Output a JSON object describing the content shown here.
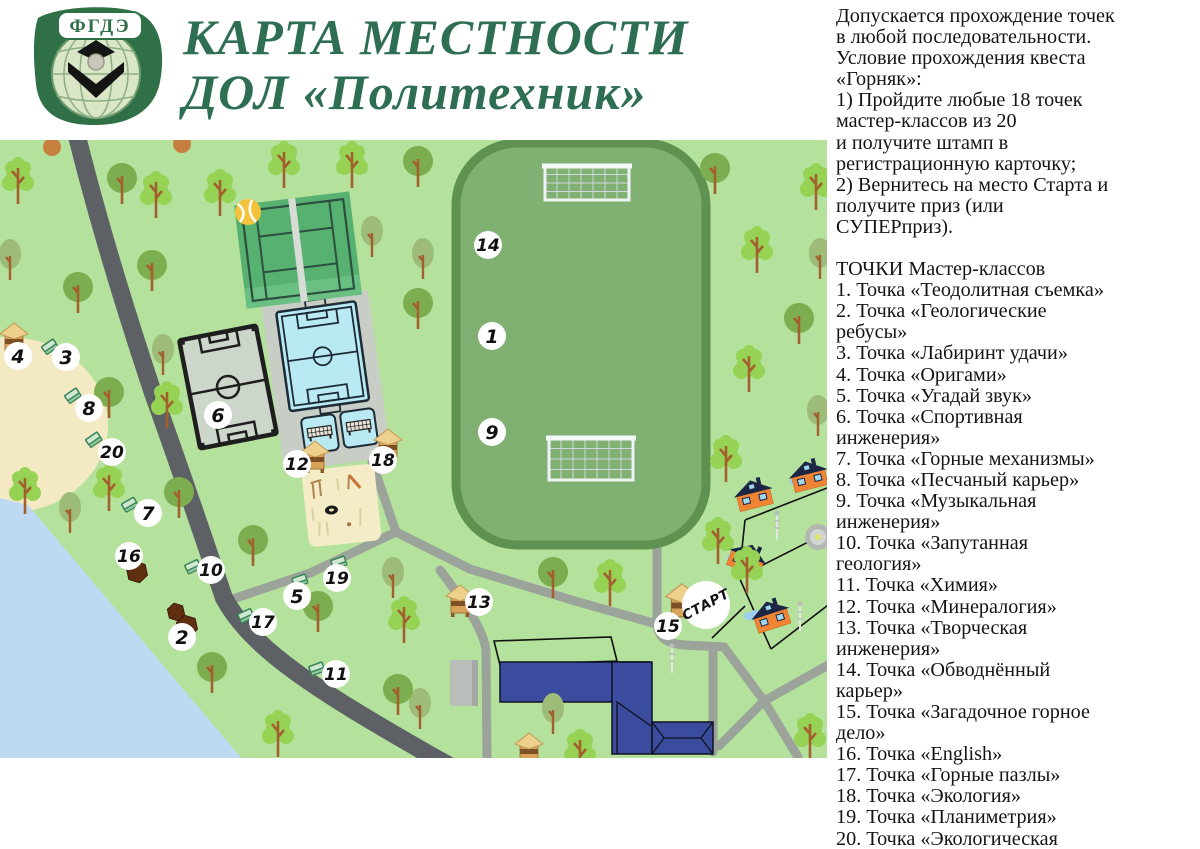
{
  "header": {
    "logo": {
      "text": "ФГДЭ"
    },
    "title_line1": "КАРТА МЕСТНОСТИ",
    "title_line2": "ДОЛ «Политехник»",
    "title_color": "#2e6e52"
  },
  "side_panel": {
    "intro_lines": [
      "Допускается прохождение точек",
      "в любой последовательности.",
      "Условие прохождения квеста",
      "«Горняк»:",
      "1) Пройдите любые 18 точек",
      "мастер-классов из 20",
      "и получите штамп в",
      "регистрационную карточку;",
      "2) Вернитесь на место Старта и",
      "получите приз (или",
      "СУПЕРприз)."
    ],
    "points_title": "ТОЧКИ Мастер-классов",
    "points": [
      "1. Точка «Теодолитная съемка»",
      "2. Точка «Геологические\nребусы»",
      "3. Точка «Лабиринт удачи»",
      "4. Точка «Оригами»",
      "5. Точка «Угадай звук»",
      "6. Точка «Спортивная\nинженерия»",
      "7. Точка «Горные механизмы»",
      "8. Точка «Песчаный карьер»",
      "9. Точка «Музыкальная\nинженерия»",
      "10. Точка «Запутанная\nгеология»",
      "11. Точка «Химия»",
      "12. Точка «Минералогия»",
      "13. Точка «Творческая\nинженерия»",
      "14. Точка «Обводнённый\nкарьер»",
      "15. Точка «Загадочное горное\nдело»",
      "16. Точка «English»",
      "17. Точка «Горные пазлы»",
      "18. Точка «Экология»",
      "19. Точка «Планиметрия»",
      "20. Точка «Экологическая\nзагадка»"
    ]
  },
  "map": {
    "start_label": "СТАРТ",
    "colors": {
      "map_bg": "#b4e19c",
      "stadium": "#80b173",
      "stadium_border": "#5f9150",
      "road_main": "#5d6165",
      "road_light": "#9ba39a",
      "lake": "#bedaf3",
      "sand": "#f3e9c3",
      "tennis": "#57b271",
      "tennis_line": "#2c5040",
      "tennis_stripe": "#d8dcd6",
      "field_grey": "#cdd6ca",
      "field_line": "#1e1e1e",
      "court_blue": "#b9e9f2",
      "court_line": "#1d2b36",
      "pad": "#c8cec6",
      "playground": "#f3ecc6",
      "building_navy": "#3b4b9e",
      "building_grey": "#b9beb9",
      "house_orange": "#ef8434",
      "roof_navy": "#1c2543",
      "window_blue": "#9fd8ef",
      "hut_body": "#d8a358",
      "hut_roof": "#ecd08c",
      "tree_round": "#7cad4f",
      "tree_bushy": "#96d355",
      "tree_oval": "#9cbc78",
      "trunk": "#a3602f",
      "blob_brown": "#5f2f10",
      "marker_bg": "#ffffff",
      "marker_text": "#111111"
    },
    "markers": [
      {
        "n": "14",
        "x": 488,
        "y": 245
      },
      {
        "n": "1",
        "x": 492,
        "y": 336
      },
      {
        "n": "9",
        "x": 492,
        "y": 432
      },
      {
        "n": "6",
        "x": 218,
        "y": 415
      },
      {
        "n": "4",
        "x": 18,
        "y": 356
      },
      {
        "n": "3",
        "x": 66,
        "y": 357
      },
      {
        "n": "8",
        "x": 89,
        "y": 408
      },
      {
        "n": "20",
        "x": 112,
        "y": 452
      },
      {
        "n": "7",
        "x": 148,
        "y": 513
      },
      {
        "n": "16",
        "x": 129,
        "y": 556
      },
      {
        "n": "10",
        "x": 211,
        "y": 570
      },
      {
        "n": "2",
        "x": 182,
        "y": 637
      },
      {
        "n": "17",
        "x": 263,
        "y": 622
      },
      {
        "n": "5",
        "x": 297,
        "y": 596
      },
      {
        "n": "19",
        "x": 337,
        "y": 578
      },
      {
        "n": "11",
        "x": 336,
        "y": 674
      },
      {
        "n": "12",
        "x": 297,
        "y": 464
      },
      {
        "n": "18",
        "x": 383,
        "y": 460
      },
      {
        "n": "13",
        "x": 479,
        "y": 602
      },
      {
        "n": "15",
        "x": 668,
        "y": 626
      }
    ],
    "start": {
      "x": 706,
      "y": 605
    },
    "huts": [
      {
        "x": 14,
        "y": 330
      },
      {
        "x": 315,
        "y": 448
      },
      {
        "x": 388,
        "y": 436
      },
      {
        "x": 460,
        "y": 592
      },
      {
        "x": 682,
        "y": 592,
        "big": 1
      },
      {
        "x": 529,
        "y": 740
      }
    ],
    "benches": [
      {
        "x": 50,
        "y": 347,
        "r": -35
      },
      {
        "x": 73,
        "y": 396,
        "r": -35
      },
      {
        "x": 94,
        "y": 440,
        "r": -35
      },
      {
        "x": 130,
        "y": 505,
        "r": -30
      },
      {
        "x": 193,
        "y": 567,
        "r": -25
      },
      {
        "x": 246,
        "y": 616,
        "r": -25
      },
      {
        "x": 300,
        "y": 581,
        "r": -20
      },
      {
        "x": 339,
        "y": 563,
        "r": -20
      },
      {
        "x": 317,
        "y": 669,
        "r": -20
      }
    ],
    "blobs": [
      {
        "x": 137,
        "y": 572,
        "r": 11
      },
      {
        "x": 176,
        "y": 612,
        "r": 9
      },
      {
        "x": 187,
        "y": 626,
        "r": 11
      }
    ],
    "trees": [
      {
        "t": "bushy",
        "x": 18,
        "y": 176
      },
      {
        "t": "round",
        "x": 122,
        "y": 178
      },
      {
        "t": "bushy",
        "x": 156,
        "y": 190
      },
      {
        "t": "bushy",
        "x": 220,
        "y": 188
      },
      {
        "t": "bushy",
        "x": 284,
        "y": 160
      },
      {
        "t": "bushy",
        "x": 352,
        "y": 160
      },
      {
        "t": "round",
        "x": 418,
        "y": 161
      },
      {
        "t": "round",
        "x": 715,
        "y": 168
      },
      {
        "t": "bushy",
        "x": 816,
        "y": 182
      },
      {
        "t": "oval",
        "x": 10,
        "y": 254
      },
      {
        "t": "round",
        "x": 78,
        "y": 287
      },
      {
        "t": "bushy",
        "x": 757,
        "y": 245
      },
      {
        "t": "oval",
        "x": 820,
        "y": 253
      },
      {
        "t": "round",
        "x": 152,
        "y": 265
      },
      {
        "t": "oval",
        "x": 372,
        "y": 231
      },
      {
        "t": "oval",
        "x": 423,
        "y": 253
      },
      {
        "t": "round",
        "x": 418,
        "y": 303
      },
      {
        "t": "oval",
        "x": 163,
        "y": 349
      },
      {
        "t": "round",
        "x": 109,
        "y": 392
      },
      {
        "t": "bushy",
        "x": 167,
        "y": 400
      },
      {
        "t": "round",
        "x": 799,
        "y": 318
      },
      {
        "t": "bushy",
        "x": 749,
        "y": 364
      },
      {
        "t": "oval",
        "x": 818,
        "y": 410
      },
      {
        "t": "bushy",
        "x": 25,
        "y": 486
      },
      {
        "t": "oval",
        "x": 70,
        "y": 507
      },
      {
        "t": "round",
        "x": 179,
        "y": 492
      },
      {
        "t": "bushy",
        "x": 109,
        "y": 483
      },
      {
        "t": "round",
        "x": 253,
        "y": 540
      },
      {
        "t": "round",
        "x": 212,
        "y": 667
      },
      {
        "t": "bushy",
        "x": 278,
        "y": 729
      },
      {
        "t": "oval",
        "x": 420,
        "y": 703
      },
      {
        "t": "round",
        "x": 553,
        "y": 572
      },
      {
        "t": "oval",
        "x": 553,
        "y": 708
      },
      {
        "t": "bushy",
        "x": 610,
        "y": 578
      },
      {
        "t": "bushy",
        "x": 580,
        "y": 748
      },
      {
        "t": "bushy",
        "x": 726,
        "y": 454
      },
      {
        "t": "bushy",
        "x": 718,
        "y": 536
      },
      {
        "t": "bushy",
        "x": 747,
        "y": 565
      },
      {
        "t": "bushy",
        "x": 810,
        "y": 732
      },
      {
        "t": "round",
        "x": 318,
        "y": 606
      },
      {
        "t": "oval",
        "x": 393,
        "y": 572
      },
      {
        "t": "bushy",
        "x": 404,
        "y": 615
      },
      {
        "t": "round",
        "x": 398,
        "y": 689
      },
      {
        "t": "cut",
        "x": 52,
        "y": 147
      },
      {
        "t": "cut",
        "x": 182,
        "y": 144
      }
    ],
    "houses": [
      {
        "x": 753,
        "y": 492,
        "r": -14
      },
      {
        "x": 808,
        "y": 473,
        "r": -14
      },
      {
        "x": 748,
        "y": 556,
        "r": 22
      },
      {
        "x": 770,
        "y": 613,
        "r": -18
      }
    ],
    "smoke": [
      {
        "x": 743,
        "y": 500
      },
      {
        "x": 796,
        "y": 482
      },
      {
        "x": 733,
        "y": 558
      },
      {
        "x": 750,
        "y": 616
      }
    ],
    "lamps": [
      {
        "x": 777,
        "y": 512
      },
      {
        "x": 800,
        "y": 603
      },
      {
        "x": 672,
        "y": 645
      }
    ],
    "fences": [
      "745,520 832,486",
      "745,520 739,577 771,649",
      "739,577 832,530",
      "771,649 832,602",
      "712,638 745,606"
    ]
  }
}
